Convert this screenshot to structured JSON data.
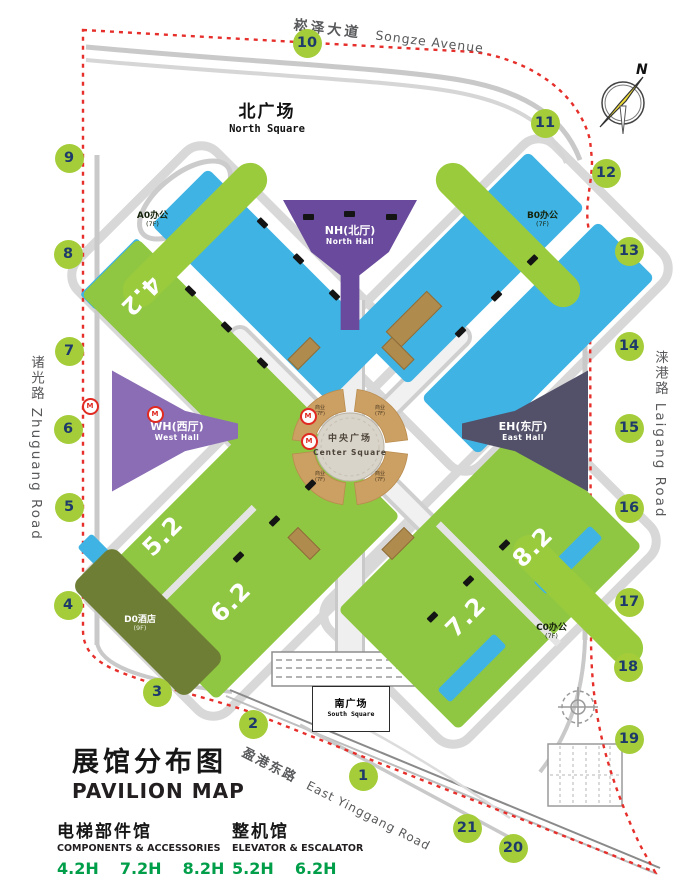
{
  "roads": {
    "songze_cn": "崧泽大道",
    "songze_en": "Songze Avenue",
    "zhuguang": "诸光路 Zhuguang Road",
    "laigang": "涞港路 Laigang Road",
    "yinggang_cn": "盈港东路",
    "yinggang_en": "East Yinggang Road"
  },
  "squares": {
    "north_cn": "北广场",
    "north_en": "North Square",
    "south_cn": "南广场",
    "south_en": "South Square",
    "center_cn": "中央广场",
    "center_en": "Center Square"
  },
  "halls": {
    "north_cn": "NH(北厅)",
    "north_en": "North Hall",
    "west_cn": "WH(西厅)",
    "west_en": "West Hall",
    "east_cn": "EH(东厅)",
    "east_en": "East Hall",
    "p42": "4.2",
    "p52": "5.2",
    "p62": "6.2",
    "p72": "7.2",
    "p82": "8.2"
  },
  "buildings": {
    "a0": {
      "label": "A0办公",
      "floors": "(7F)"
    },
    "b0": {
      "label": "B0办公",
      "floors": "(7F)"
    },
    "c0": {
      "label": "C0办公",
      "floors": "(7F)"
    },
    "d0": {
      "label": "D0酒店",
      "floors": "(9F)"
    }
  },
  "commercial": {
    "label": "商业",
    "floors": "(7F)",
    "positions": [
      [
        320,
        412
      ],
      [
        380,
        412
      ],
      [
        320,
        478
      ],
      [
        380,
        478
      ]
    ]
  },
  "gates": [
    {
      "n": "1",
      "x": 363,
      "y": 776
    },
    {
      "n": "2",
      "x": 253,
      "y": 724
    },
    {
      "n": "3",
      "x": 157,
      "y": 692
    },
    {
      "n": "4",
      "x": 68,
      "y": 605
    },
    {
      "n": "5",
      "x": 69,
      "y": 507
    },
    {
      "n": "6",
      "x": 68,
      "y": 429
    },
    {
      "n": "7",
      "x": 69,
      "y": 351
    },
    {
      "n": "8",
      "x": 68,
      "y": 254
    },
    {
      "n": "9",
      "x": 69,
      "y": 158
    },
    {
      "n": "10",
      "x": 307,
      "y": 43
    },
    {
      "n": "11",
      "x": 545,
      "y": 123
    },
    {
      "n": "12",
      "x": 606,
      "y": 173
    },
    {
      "n": "13",
      "x": 629,
      "y": 251
    },
    {
      "n": "14",
      "x": 629,
      "y": 346
    },
    {
      "n": "15",
      "x": 629,
      "y": 428
    },
    {
      "n": "16",
      "x": 629,
      "y": 508
    },
    {
      "n": "17",
      "x": 629,
      "y": 602
    },
    {
      "n": "18",
      "x": 628,
      "y": 667
    },
    {
      "n": "19",
      "x": 629,
      "y": 739
    },
    {
      "n": "20",
      "x": 513,
      "y": 848
    },
    {
      "n": "21",
      "x": 467,
      "y": 828
    }
  ],
  "doors": [
    [
      190,
      291,
      45
    ],
    [
      226,
      327,
      45
    ],
    [
      262,
      363,
      45
    ],
    [
      262,
      223,
      45
    ],
    [
      298,
      259,
      45
    ],
    [
      334,
      295,
      45
    ],
    [
      460,
      332,
      -45
    ],
    [
      496,
      296,
      -45
    ],
    [
      532,
      260,
      -45
    ],
    [
      308,
      217,
      0
    ],
    [
      349,
      214,
      0
    ],
    [
      391,
      217,
      0
    ],
    [
      238,
      557,
      -45
    ],
    [
      274,
      521,
      -45
    ],
    [
      310,
      485,
      -45
    ],
    [
      432,
      617,
      -45
    ],
    [
      468,
      581,
      -45
    ],
    [
      504,
      545,
      -45
    ]
  ],
  "metro_stations": [
    [
      88,
      404
    ],
    [
      153,
      412
    ],
    [
      306,
      414
    ],
    [
      307,
      439
    ]
  ],
  "metro_glyph": "M",
  "wedges": [
    {
      "x": 303,
      "y": 352,
      "r": -45,
      "w": 30,
      "h": 13
    },
    {
      "x": 397,
      "y": 352,
      "r": 45,
      "w": 30,
      "h": 13
    },
    {
      "x": 303,
      "y": 542,
      "r": 45,
      "w": 30,
      "h": 13
    },
    {
      "x": 397,
      "y": 542,
      "r": -45,
      "w": 30,
      "h": 13
    },
    {
      "x": 413,
      "y": 318,
      "r": -45,
      "w": 56,
      "h": 20
    }
  ],
  "compass": {
    "label": "N"
  },
  "legend": {
    "title_cn": "展馆分布图",
    "title_en": "PAVILION MAP",
    "groups": [
      {
        "cn": "电梯部件馆",
        "en": "COMPONENTS & ACCESSORIES",
        "halls": [
          "4.2H",
          "7.2H",
          "8.2H"
        ]
      },
      {
        "cn": "整机馆",
        "en": "ELEVATOR & ESCALATOR",
        "halls": [
          "5.2H",
          "6.2H"
        ]
      }
    ]
  },
  "colors": {
    "hall_green": "#8fc742",
    "hall_blue": "#3fb3e4",
    "north_hall_purple": "#6a4a9c",
    "west_hall_purple": "#8a6db5",
    "east_hall_slate": "#53516a",
    "center_tan": "#cc9f63",
    "hotel_olive": "#6e7f35",
    "gate_green": "#a5cd39",
    "gate_number_navy": "#1d3a6b",
    "boundary_red": "#e62e2a",
    "legend_green": "#009e49",
    "road_label_gray": "#58595b"
  }
}
